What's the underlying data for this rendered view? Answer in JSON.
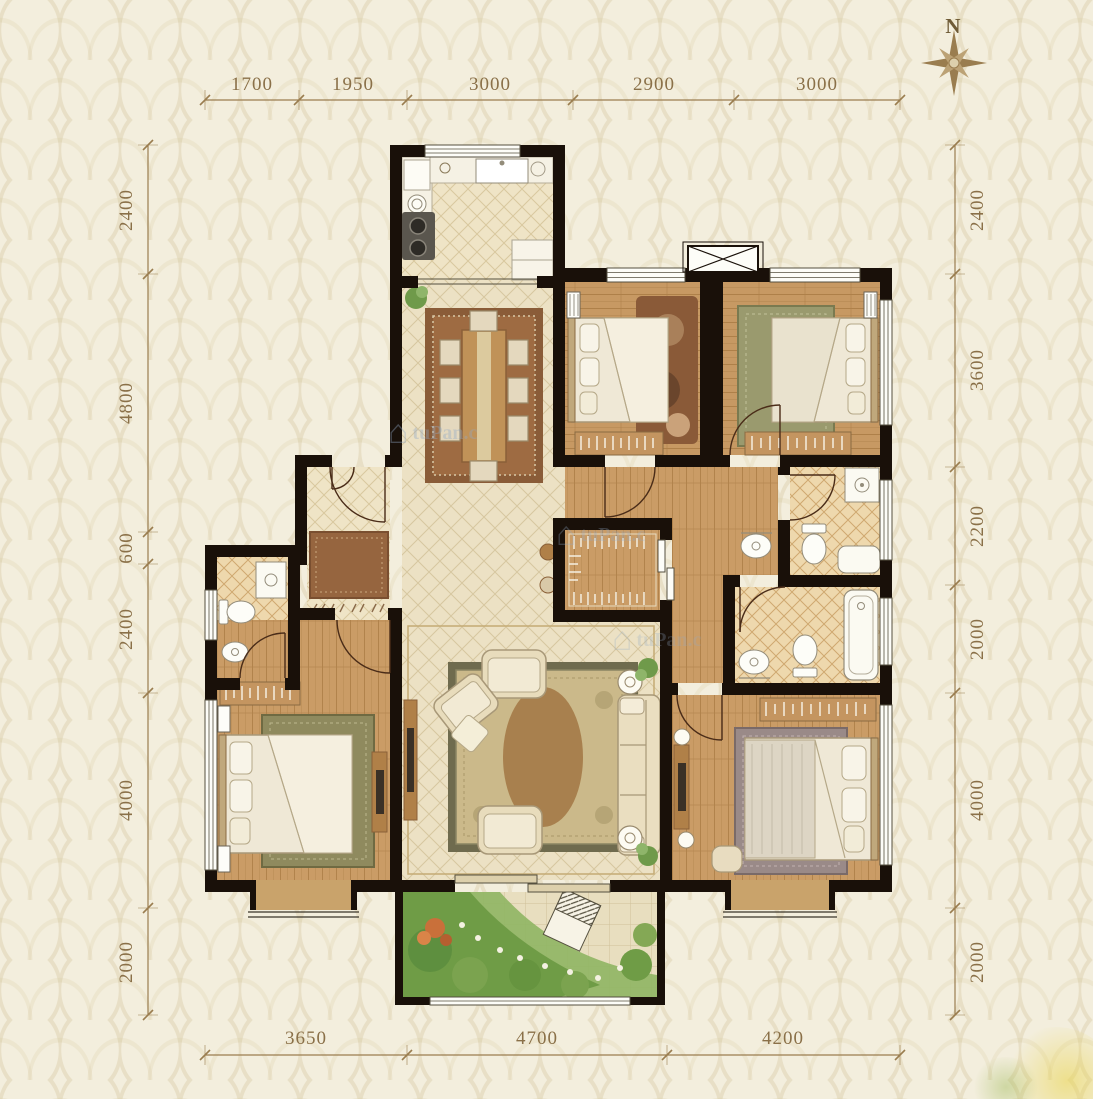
{
  "compass": {
    "label": "N"
  },
  "watermark": {
    "icon_glyph": "⌂",
    "text": "tuPan.c"
  },
  "dimensions": {
    "top": [
      {
        "value": "1700"
      },
      {
        "value": "1950"
      },
      {
        "value": "3000"
      },
      {
        "value": "2900"
      },
      {
        "value": "3000"
      }
    ],
    "bottom": [
      {
        "value": "3650"
      },
      {
        "value": "4700"
      },
      {
        "value": "4200"
      }
    ],
    "left": [
      {
        "value": "2400"
      },
      {
        "value": "4800"
      },
      {
        "value": "600"
      },
      {
        "value": "2400"
      },
      {
        "value": "4000"
      },
      {
        "value": "2000"
      }
    ],
    "right": [
      {
        "value": "2400"
      },
      {
        "value": "3600"
      },
      {
        "value": "2200"
      },
      {
        "value": "2000"
      },
      {
        "value": "4000"
      },
      {
        "value": "2000"
      }
    ]
  },
  "colors": {
    "background": "#f3eedd",
    "wall": "#191009",
    "dimension": "#8a7048",
    "wood": "#ca9c66",
    "tile": "#ece1c4",
    "bath_tile": "#eed8ad",
    "rug_brown": "#9e6b42",
    "rug_green": "#8f8a5e",
    "garden_green": "#7ba34f"
  }
}
